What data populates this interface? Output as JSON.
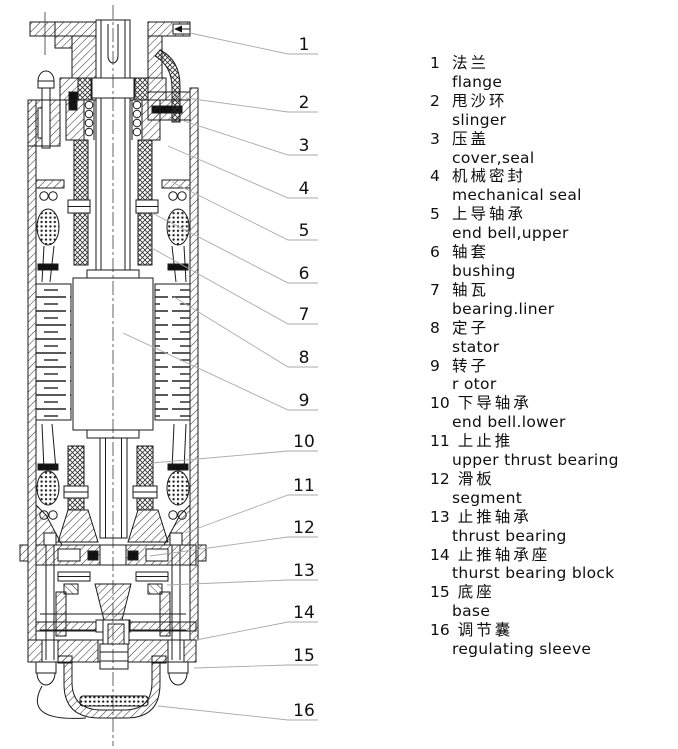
{
  "figure": {
    "title": "submersible motor cross-section diagram",
    "colors": {
      "background": "#ffffff",
      "line": "#1a1a1a",
      "leader_line": "#a9a9a9",
      "text": "#111111"
    }
  },
  "callouts": [
    {
      "num": "1"
    },
    {
      "num": "2"
    },
    {
      "num": "3"
    },
    {
      "num": "4"
    },
    {
      "num": "5"
    },
    {
      "num": "6"
    },
    {
      "num": "7"
    },
    {
      "num": "8"
    },
    {
      "num": "9"
    },
    {
      "num": "10"
    },
    {
      "num": "11"
    },
    {
      "num": "12"
    },
    {
      "num": "13"
    },
    {
      "num": "14"
    },
    {
      "num": "15"
    },
    {
      "num": "16"
    }
  ],
  "parts": [
    {
      "num": "1",
      "zh": "法兰",
      "en": "flange"
    },
    {
      "num": "2",
      "zh": "甩沙环",
      "en": "slinger"
    },
    {
      "num": "3",
      "zh": "压盖",
      "en": "cover,seal"
    },
    {
      "num": "4",
      "zh": "机械密封",
      "en": "mechanical seal"
    },
    {
      "num": "5",
      "zh": "上导轴承",
      "en": "end bell,upper"
    },
    {
      "num": "6",
      "zh": "轴套",
      "en": "bushing"
    },
    {
      "num": "7",
      "zh": "轴瓦",
      "en": "bearing.liner"
    },
    {
      "num": "8",
      "zh": "定子",
      "en": "stator"
    },
    {
      "num": "9",
      "zh": "转子",
      "en": "r otor"
    },
    {
      "num": "10",
      "zh": "下导轴承",
      "en": "end bell.lower"
    },
    {
      "num": "11",
      "zh": "上止推",
      "en": "upper thrust bearing"
    },
    {
      "num": "12",
      "zh": "滑板",
      "en": "segment"
    },
    {
      "num": "13",
      "zh": "止推轴承",
      "en": "thrust bearing"
    },
    {
      "num": "14",
      "zh": "止推轴承座",
      "en": "thurst bearing block"
    },
    {
      "num": "15",
      "zh": "底座",
      "en": "base"
    },
    {
      "num": "16",
      "zh": "调节囊",
      "en": "regulating sleeve"
    }
  ]
}
